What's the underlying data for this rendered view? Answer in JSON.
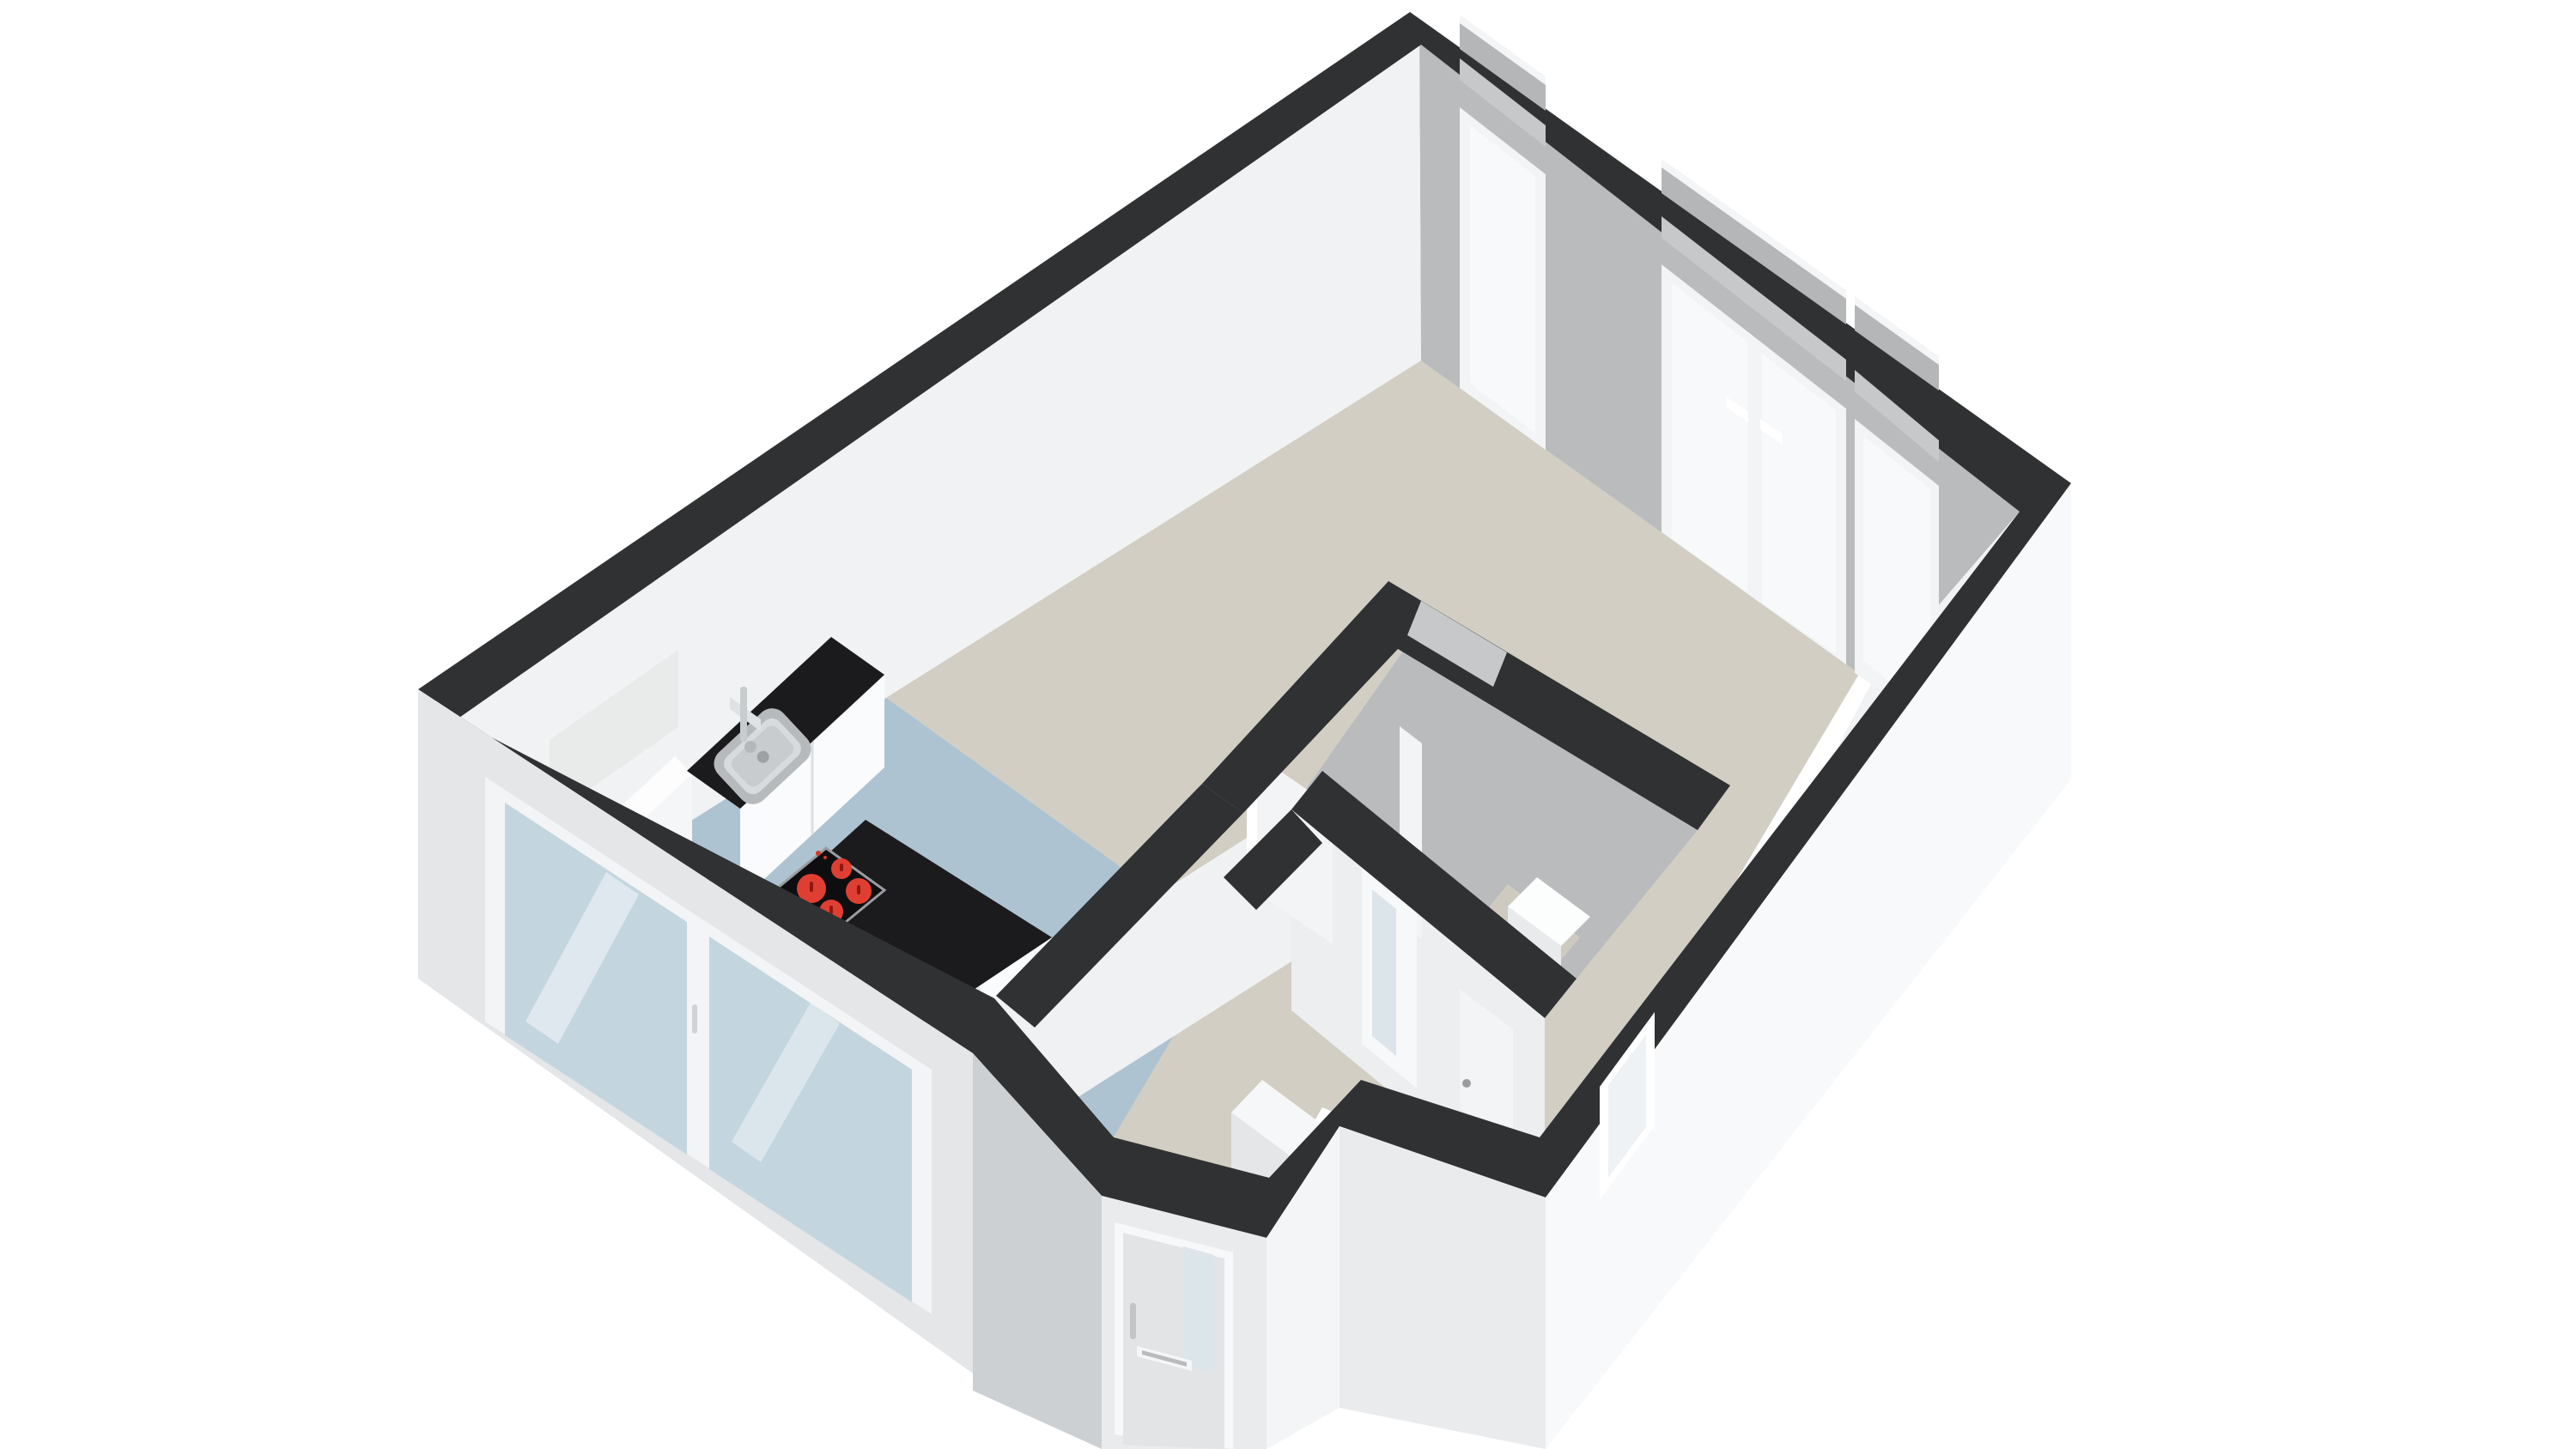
{
  "scene": {
    "type": "3d-floor-plan-render",
    "view": "isometric bird's-eye, viewed from lower-left",
    "background": "#ffffff",
    "text_visible_on_screen": "none"
  },
  "colors": {
    "wall_top_band": "#2f3132",
    "interior_wall_gray": "#b9bbbd",
    "interior_wall_white": "#f1f2f3",
    "interior_wall_soft": "#eceeef",
    "exterior_wall_bright": "#f8f9fa",
    "exterior_wall_light": "#e9ebed",
    "exterior_wall_mid": "#e4e6e8",
    "exterior_wall_shaded": "#cdd0d2",
    "floor_main": "#d3cec4",
    "floor_kitchen": "#aec3d1",
    "floor_bath_patch": "#cfcac0",
    "window_glass": "#f7f9fa",
    "sliding_glass": "#c3d6e0",
    "frosted_glass": "#dce5ea",
    "frame_white": "#f2f4f5",
    "notch_gray": "#c6c8ca",
    "window_box_gray": "#b4b6b8",
    "countertop_black": "#1b1b1d",
    "cooktop_panel": "#0e0e10",
    "burner_red": "#df3f33",
    "burner_mark": "#8e1810",
    "oven_black": "#131315",
    "steel": "#b7babc",
    "steel_light": "#d8dbdd",
    "steel_mid": "#c9ccce",
    "door_leaf_white": "#f3f4f5",
    "door_leaf_gray": "#e2e4e6",
    "cabinet_white": "#fafbfc",
    "cabinet_tall": "#f5f6f7",
    "seam_gray": "#dcdee0",
    "toilet_white": "#fcfdfd",
    "toilet_shade": "#e8eaec",
    "panel_pale": "#e9eaea"
  },
  "rooms": [
    {
      "id": "living-dining",
      "floor": "beige",
      "position": "upper-right open space"
    },
    {
      "id": "kitchen",
      "floor": "blue",
      "position": "left, along top-left and bottom-left walls"
    },
    {
      "id": "hallway",
      "floor": "beige",
      "position": "bottom-center, from entrance vestibule"
    },
    {
      "id": "bathroom",
      "walls": "gray",
      "position": "bottom-right interior block",
      "fixtures": [
        "toilet",
        "open door"
      ]
    },
    {
      "id": "toilet-room",
      "walls": "white",
      "position": "below bathroom",
      "door": "frosted-glass"
    },
    {
      "id": "entrance-vestibule",
      "position": "protruding bay on bottom-left wall",
      "door": "entrance door with glass pane and mail slot"
    }
  ],
  "openings": {
    "window_wall": [
      {
        "id": "window-1",
        "type": "full-height-window"
      },
      {
        "id": "french-doors",
        "type": "double-door",
        "handles": 2
      },
      {
        "id": "window-2",
        "type": "full-height-window"
      }
    ],
    "bottom_left_wall": [
      {
        "id": "sliding-doors",
        "type": "glass-slider",
        "panels": 2
      }
    ],
    "bottom_right_wall": [
      {
        "id": "small-window",
        "type": "window"
      }
    ],
    "interior": [
      {
        "id": "hall-door",
        "type": "white-door"
      },
      {
        "id": "bathroom-door",
        "type": "white-door-open"
      },
      {
        "id": "frosted-door",
        "type": "door-with-frosted-glass-strip"
      },
      {
        "id": "corner-door",
        "type": "white-door"
      }
    ]
  },
  "kitchen": {
    "counter": [
      "dark worktop",
      "inset stainless sink",
      "chrome faucet",
      "built-in oven",
      "tall cabinets",
      "pale wall panel"
    ],
    "island": {
      "worktop": "black",
      "cooktop_burners": 4,
      "burner_color": "red",
      "fronts": "white drawers"
    }
  },
  "fixtures": [
    "toilet",
    "step-platform"
  ]
}
